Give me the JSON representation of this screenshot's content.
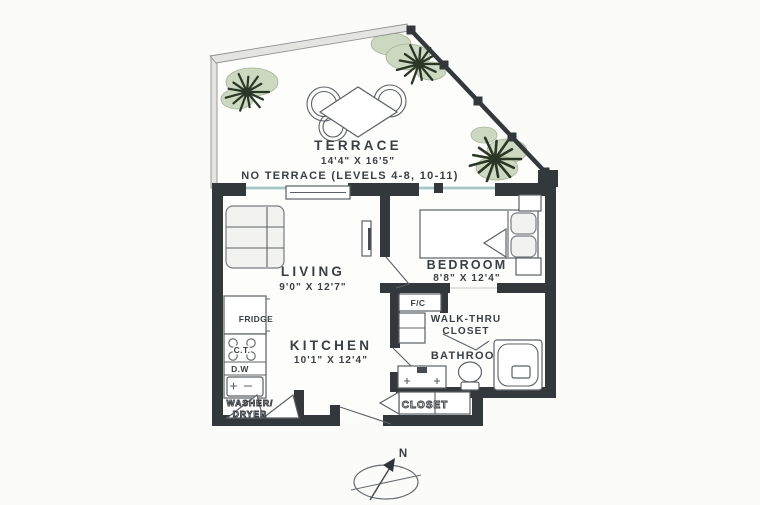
{
  "plan": {
    "terrace": {
      "label": "TERRACE",
      "dims": "14'4\" X 16'5\"",
      "note": "NO TERRACE (LEVELS 4-8, 10-11)"
    },
    "living": {
      "label": "LIVING",
      "dims": "9'0\" X 12'7\""
    },
    "bedroom": {
      "label": "BEDROOM",
      "dims": "8'8\" X 12'4\""
    },
    "kitchen": {
      "label": "KITCHEN",
      "dims": "10'1\" X 12'4\"",
      "fridge_label": "FRIDGE",
      "cooktop_label": "C.T.",
      "dishwasher_label": "D.W"
    },
    "laundry": {
      "label_line1": "WASHER/",
      "label_line2": "DRYER"
    },
    "fan_coil": {
      "label": "F/C"
    },
    "walk_thru_closet": {
      "label_line1": "WALK-THRU",
      "label_line2": "CLOSET"
    },
    "bathroom": {
      "label": "BATHROOM"
    },
    "entry_closet": {
      "label": "CLOSET"
    },
    "compass": {
      "north_label": "N"
    }
  },
  "colors": {
    "wall": "#33383d",
    "glass": "#aedbd8",
    "plant_fill": "#ccd8c0",
    "plant_stroke": "#2a3626",
    "text": "#3a3f44",
    "floor": "#fdfdfc",
    "bg": "#fbfbf9",
    "line": "#5c6166"
  }
}
